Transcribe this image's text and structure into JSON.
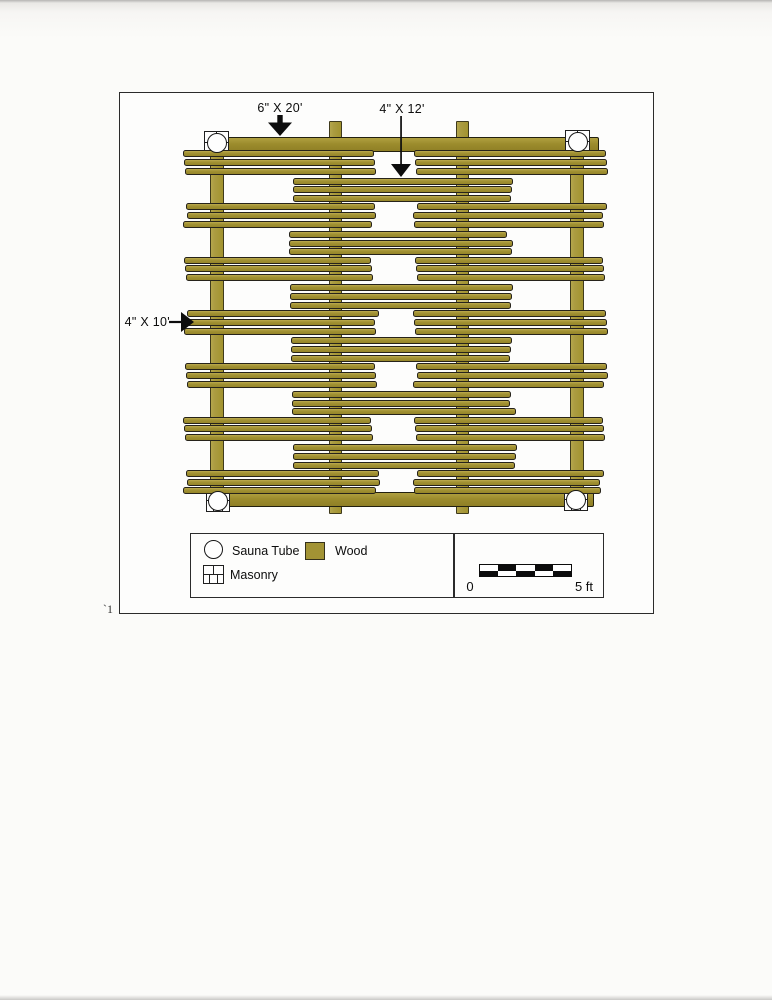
{
  "document": {
    "page_number_mark": "`1"
  },
  "annotations": {
    "top_beam_label": "6\" X 20'",
    "center_plank_label": "4\" X 12'",
    "side_plank_label": "4\" X 10'"
  },
  "legend": {
    "items": [
      {
        "key": "sauna-tube",
        "label": "Sauna Tube"
      },
      {
        "key": "wood",
        "label": "Wood"
      },
      {
        "key": "masonry",
        "label": "Masonry"
      }
    ]
  },
  "scale_bar": {
    "zero_label": "0",
    "end_label": "5 ft",
    "segments": 5,
    "feet": 5
  },
  "colors": {
    "wood_plank": "#a29233",
    "wood_beam": "#9c8c2d",
    "wood_post": "#ab9c41",
    "outline": "#26231a",
    "masonry_line": "#1f1f1f"
  },
  "structure": {
    "description": "plan view of timber crib platform",
    "side_rows": 7,
    "center_rows": 6,
    "planks_per_group": 3,
    "side_row_first_y": 57,
    "center_row_first_y": 84.5,
    "row_pitch": 53.3,
    "plank_step": 8.8,
    "left_group": {
      "x": 65,
      "w": 190
    },
    "right_group": {
      "x": 295,
      "w": 190
    },
    "center_group": {
      "x": 171,
      "w": 221
    },
    "beams": [
      {
        "x": 86,
        "y": 44,
        "w": 393,
        "h": 15
      },
      {
        "x": 88,
        "y": 399,
        "w": 386,
        "h": 15
      }
    ],
    "verticals": [
      {
        "x": 90,
        "y": 58,
        "w": 14,
        "h": 341
      },
      {
        "x": 209,
        "y": 28,
        "w": 13,
        "h": 393
      },
      {
        "x": 336,
        "y": 28,
        "w": 13,
        "h": 393
      },
      {
        "x": 450,
        "y": 58,
        "w": 14,
        "h": 341
      }
    ],
    "corners": [
      {
        "x": 84,
        "y": 38,
        "w": 25,
        "h": 23
      },
      {
        "x": 445,
        "y": 37,
        "w": 25,
        "h": 23
      },
      {
        "x": 86,
        "y": 396,
        "w": 24,
        "h": 23
      },
      {
        "x": 444,
        "y": 395,
        "w": 24,
        "h": 23
      }
    ]
  }
}
